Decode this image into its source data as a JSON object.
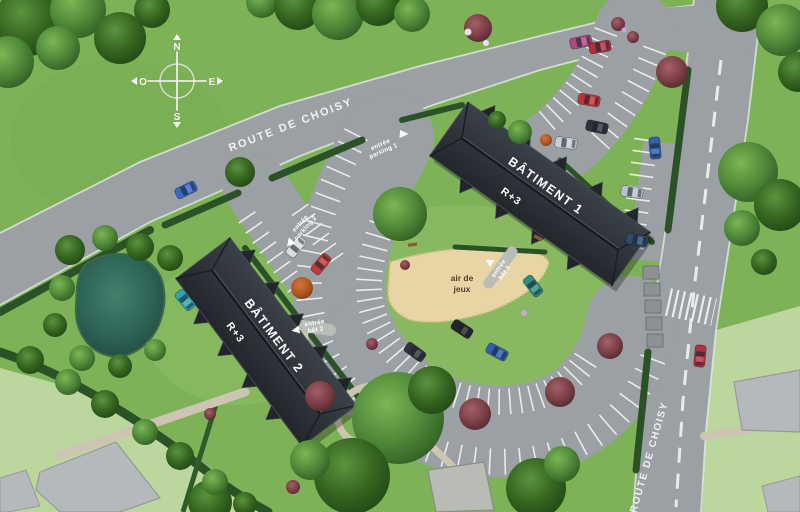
{
  "compass": {
    "n": "N",
    "s": "S",
    "e": "E",
    "o": "O"
  },
  "roads": {
    "top": {
      "name": "ROUTE DE CHOISY"
    },
    "right": {
      "name": "ROUTE DE CHOISY"
    }
  },
  "buildings": {
    "b1": {
      "name": "BÂTIMENT 1",
      "level": "R+3"
    },
    "b2": {
      "name": "BÂTIMENT 2",
      "level": "R+3"
    }
  },
  "playground": {
    "line1": "air de",
    "line2": "jeux"
  },
  "labels": {
    "parking1": {
      "line1": "entrée",
      "line2": "parking 1"
    },
    "parking2": {
      "line1": "entrée",
      "line2": "parking 2"
    },
    "bat1": {
      "line1": "entrée",
      "line2": "bât 1"
    },
    "bat2": {
      "line1": "entrée",
      "line2": "bât 2"
    }
  },
  "colors": {
    "grass": "#7eb257",
    "pale_parcel": "#bcd79d",
    "road": "#9aa0a3",
    "roof": "#2e3338",
    "sand": "#e8d5a5",
    "pond": "#2a6b59",
    "hedge": "#2b5227",
    "stripe": "#f6f6f6"
  }
}
